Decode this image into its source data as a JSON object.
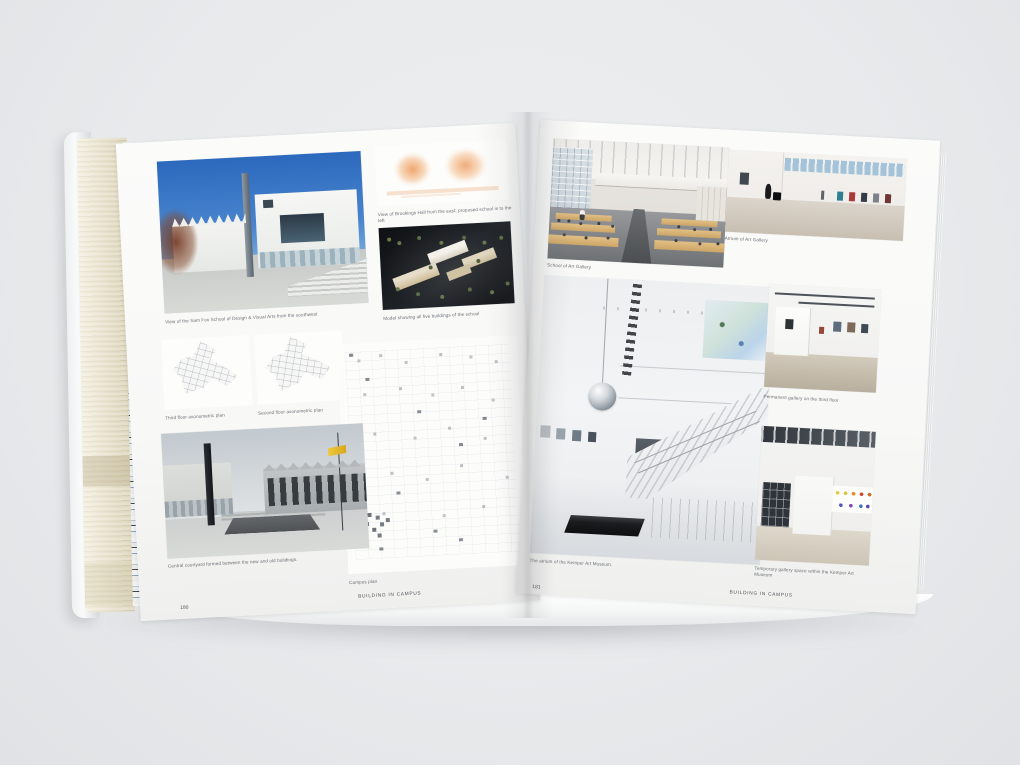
{
  "palette": {
    "background": "#e8eaec",
    "page": "#fafaf9",
    "fore_edge_cream": "#e3dabd",
    "sky_blue": "#3b78c8",
    "sketch_peach": "#eda268",
    "caption_text": "#6b6f73",
    "dot_yellow": "#e8ca3e",
    "dot_orange": "#e08a28",
    "dot_red": "#cf4a2e",
    "dot_blue": "#4a5ab2",
    "dot_purple": "#7a4cb0"
  },
  "left_page": {
    "captions": {
      "main_photo": "View of the Sam Fox School of Design & Visual Arts from the southwest",
      "sketch": "View of Brookings Hall from the east; proposed school is to the left",
      "model": "Model showing all five buildings of the school",
      "plan_third": "Third floor axonometric plan",
      "plan_second": "Second floor axonometric plan",
      "courtyard": "Central courtyard formed between the new and old buildings.",
      "campus_plan": "Campus plan"
    },
    "footer": {
      "page_number": "180",
      "section_title": "BUILDING IN CAMPUS"
    }
  },
  "right_page": {
    "captions": {
      "studio": "School of Art Gallery",
      "gallery": "Atrium of Art Gallery",
      "atrium": "The atrium of the Kemper Art Museum.",
      "permanent": "Permanent gallery on the third floor",
      "temporary": "Temporary gallery space within the Kemper Art Museum"
    },
    "footer": {
      "page_number": "181",
      "section_title": "BUILDING IN CAMPUS"
    }
  }
}
